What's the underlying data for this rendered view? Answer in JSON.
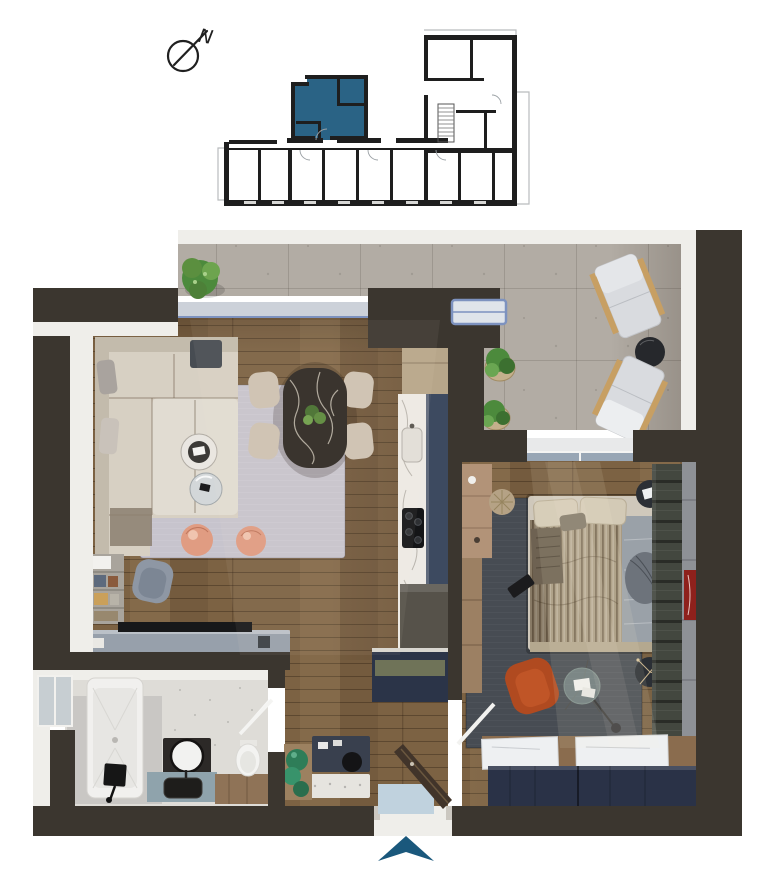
{
  "compass": {
    "label": "N"
  },
  "key_plan": {
    "description": "building-level key plan with current unit highlighted",
    "highlighted_unit_color": "#2a6385"
  },
  "entrance_arrow": {
    "color": "#1a587c",
    "direction": "up"
  },
  "rooms": [
    {
      "name": "living-dining-room",
      "furniture": [
        "corner-sofa",
        "coffee-tables",
        "coral-poufs",
        "armchair",
        "bookshelf",
        "tv-console",
        "dining-table",
        "dining-chairs"
      ]
    },
    {
      "name": "kitchen",
      "furniture": [
        "tall-cabinet",
        "marble-counter",
        "cooktop",
        "sink",
        "base-cabinets"
      ]
    },
    {
      "name": "bathroom",
      "furniture": [
        "bathtub",
        "vanity-mirror",
        "sink-counter",
        "toilet",
        "shower-fixture"
      ]
    },
    {
      "name": "hallway",
      "furniture": [
        "closet",
        "bench",
        "planter",
        "entrance-door",
        "doormat"
      ]
    },
    {
      "name": "bedroom",
      "furniture": [
        "double-bed",
        "side-tables",
        "rust-armchair",
        "glass-table",
        "wardrobe",
        "dressers",
        "desk-strip"
      ]
    },
    {
      "name": "balcony",
      "furniture": [
        "plant"
      ]
    },
    {
      "name": "terrace",
      "furniture": [
        "two-loungers",
        "round-table",
        "basket-plants"
      ]
    }
  ],
  "palette": {
    "wall": "#3b362f",
    "white_trim": "#efeeea",
    "concrete": "#b2aca4",
    "glazing": "#ccd1d9",
    "window_blue": "#7d92bf",
    "wood": "#7c6243",
    "wood_desk": "#b29378",
    "rug_living": "#c7c4cd",
    "rug_bedroom": "#474c53",
    "sofa": "#d7d0c3",
    "sofa_dark": "#c3bbac",
    "dining_table": "#2e2924",
    "chair_beige": "#cec2b2",
    "pouf_coral": "#e09c82",
    "marble": "#edeae5",
    "kitchen_navy": "#3d4a60",
    "cabinet_beige": "#b7a68a",
    "cabinet_dark": "#2a3442",
    "grey_block": "#56524a",
    "closet_navy": "#2b3448",
    "closet_olive": "#6f7358",
    "bench_navy": "#39404e",
    "door_brown": "#41342a",
    "mat_blue": "#c0d2de",
    "bath_wall": "#dedcd7",
    "bath_floor": "#c9c7c4",
    "tub_white": "#f1f0ee",
    "bath_counter": "#8fa3ac",
    "vanity_dark": "#2c2927",
    "toilet_wood": "#8f7357",
    "bed_base": "#cfc8bb",
    "bed_stripe": "#a89a82",
    "bed_grey": "#9aa1a8",
    "wardrobe": "#43473f",
    "panel_grey": "#8e9196",
    "art_red": "#8e211c",
    "dresser_navy": "#2a3247",
    "dresser_wood": "#8a6c4e",
    "chair_rust": "#b04a20",
    "table_black": "#2b2f35",
    "plant_green": "#4c8a3c",
    "plant_teal": "#2e7d58",
    "console_grey": "#97a0ab",
    "tv_black": "#17181a",
    "lounger": "#d9dbdf",
    "lounger_wood": "#c79f63",
    "teal_unit": "#2a6385",
    "teal_arrow": "#1a587c",
    "keyplan_wall": "#1e1e1e",
    "keyplan_line": "#b9bcbe"
  }
}
